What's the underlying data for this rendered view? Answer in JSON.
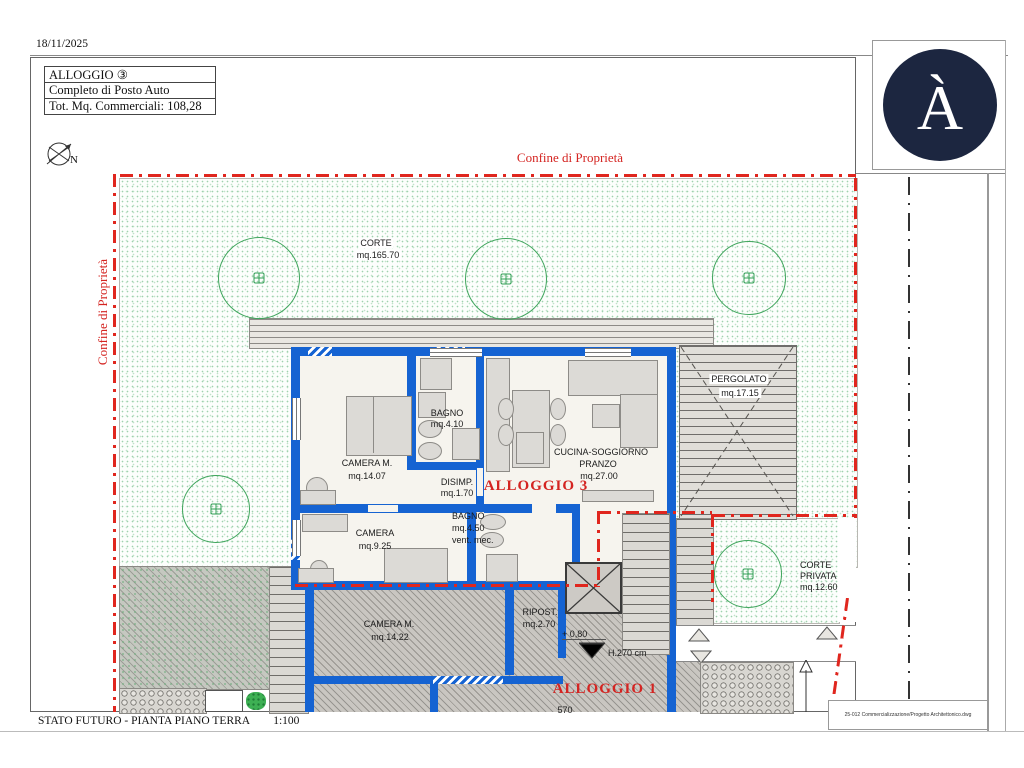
{
  "page": {
    "date": "18/11/2025",
    "footer": {
      "left": "STATO FUTURO - PIANTA PIANO TERRA",
      "scale": "1:100",
      "file_ref": "25-012 Commercializzazione/Progetto Architettonico.dwg"
    }
  },
  "title_block": {
    "line1": "ALLOGGIO ③",
    "line2": "Completo di Posto Auto",
    "line3": "Tot. Mq. Commerciali: 108,28"
  },
  "logo": {
    "letter": "À"
  },
  "compass": {
    "label": "N"
  },
  "boundary": {
    "top_label": "Confine di Proprietà",
    "left_label": "Confine di Proprietà"
  },
  "site": {
    "corte": {
      "name": "CORTE",
      "area": "mq.165.70"
    },
    "pergolato": {
      "name": "PERGOLATO",
      "area": "mq.17.15"
    },
    "corte_privata": {
      "name": "CORTE",
      "name2": "PRIVATA",
      "area": "mq.12.60"
    }
  },
  "apartment3": {
    "label": "ALLOGGIO 3",
    "camera_m": {
      "name": "CAMERA  M.",
      "area": "mq.14.07"
    },
    "bagno": {
      "name": "BAGNO",
      "area": "mq.4.10"
    },
    "disimp": {
      "name": "DISIMP.",
      "area": "mq.1.70"
    },
    "cucina": {
      "name": "CUCINA-SOGGIORNO",
      "name2": "PRANZO",
      "area": "mq.27.00"
    },
    "camera": {
      "name": "CAMERA",
      "area": "mq.9.25"
    },
    "bagno2": {
      "name": "BAGNO",
      "area": "mq.4.50",
      "note": "vent. mec."
    }
  },
  "apartment1": {
    "label": "ALLOGGIO 1",
    "camera_m": {
      "name": "CAMERA  M.",
      "area": "mq.14.22"
    },
    "ripost": {
      "name": "RIPOST.",
      "area": "mq.2.70"
    }
  },
  "levels": {
    "l080": "+ 0,80",
    "l075": "+ 0,75",
    "h270": "H.270  cm"
  },
  "dims": {
    "d570": "570"
  },
  "colors": {
    "wall_blue": "#1563d2",
    "boundary_red": "#e0261e",
    "label_red": "#d42421",
    "tree_green": "#3fa55c",
    "logo_navy": "#1c2640"
  }
}
